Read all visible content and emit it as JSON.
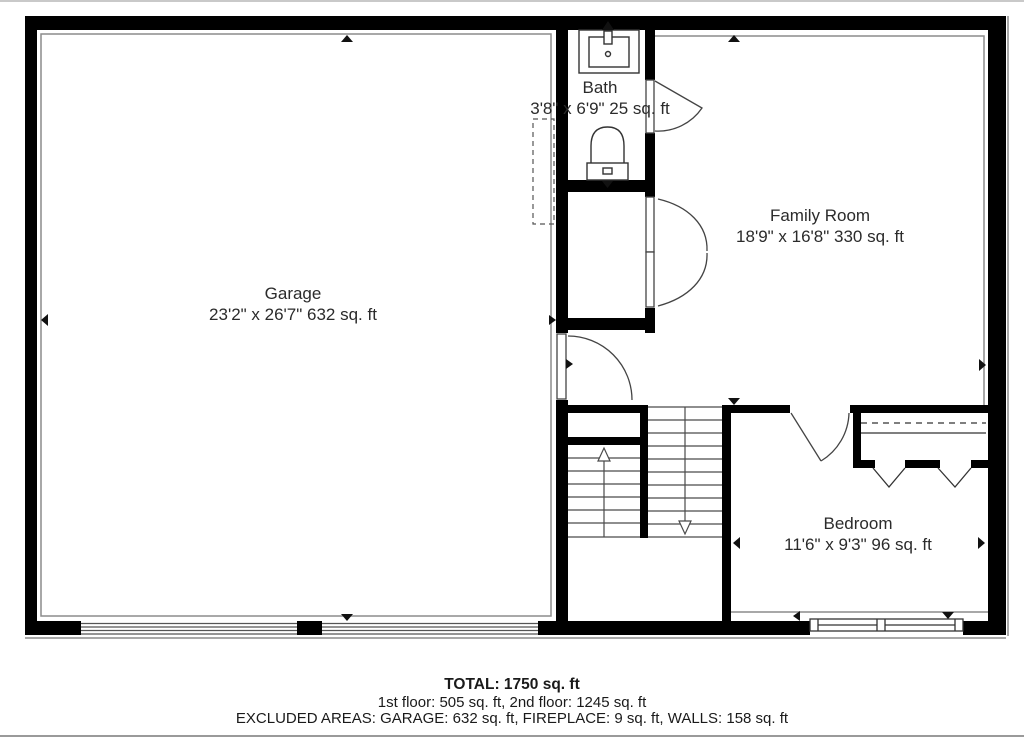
{
  "plan": {
    "rooms": {
      "garage": {
        "name": "Garage",
        "dims": "23'2\" x 26'7\" 632 sq. ft"
      },
      "bath": {
        "name": "Bath",
        "dims": "3'8\" x 6'9\" 25 sq. ft"
      },
      "family_room": {
        "name": "Family Room",
        "dims": "18'9\" x 16'8\" 330 sq. ft"
      },
      "bedroom": {
        "name": "Bedroom",
        "dims": "11'6\" x 9'3\" 96 sq. ft"
      }
    },
    "summary": {
      "total": "TOTAL: 1750 sq. ft",
      "floors": "1st floor: 505 sq. ft, 2nd floor: 1245 sq. ft",
      "excluded": "EXCLUDED AREAS: GARAGE: 632 sq. ft, FIREPLACE: 9 sq. ft, WALLS: 158 sq. ft"
    },
    "colors": {
      "wall": "#000000",
      "stair_line": "#4a4a4a",
      "inset_line": "#8c8c8c",
      "text": "#2b2b2b"
    }
  }
}
